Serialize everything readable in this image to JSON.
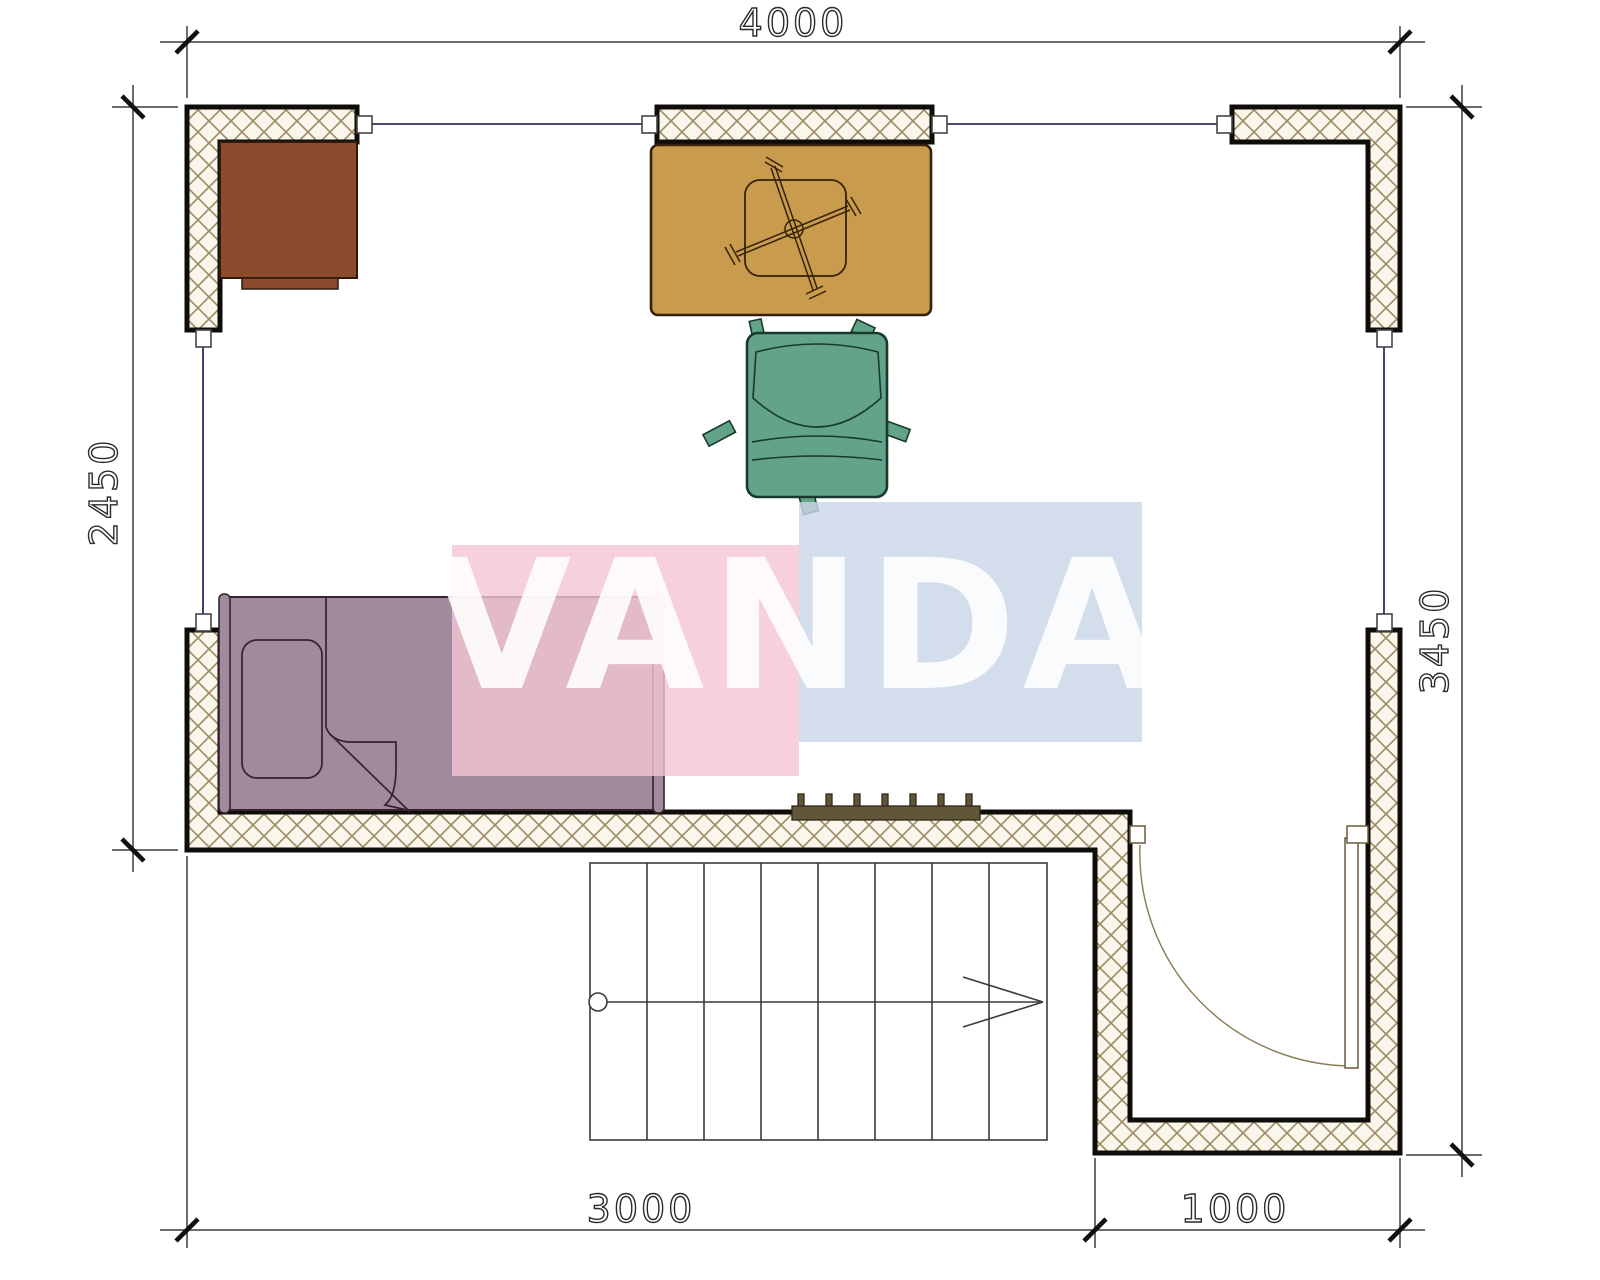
{
  "watermark": {
    "text": "VANDA"
  },
  "dimensions": {
    "top": "4000",
    "left": "2450",
    "right": "3450",
    "bottom_left": "3000",
    "bottom_right": "1000"
  },
  "colors": {
    "wall_bg": "#faf6ec",
    "wall_hatch": "#9c8c63",
    "wall_border": "#0f0d0a",
    "window_line": "#2e2e5e",
    "desk": "#8d4a2c",
    "table": "#c99b4d",
    "table_stroke": "#352208",
    "chair": "#63a489",
    "chair_stroke": "#173a2c",
    "bed": "#a18a9b",
    "radiator": "#615638",
    "door": "#8a7a55",
    "watermark_pink": "#f4c6d2",
    "watermark_blue": "#c9d6e7"
  },
  "legend": {
    "desk": "corner-desk",
    "table": "work-table",
    "chair": "office-chair",
    "bed": "single-bed",
    "radiator": "radiator",
    "stairs": "staircase-down",
    "door": "entry-door"
  }
}
